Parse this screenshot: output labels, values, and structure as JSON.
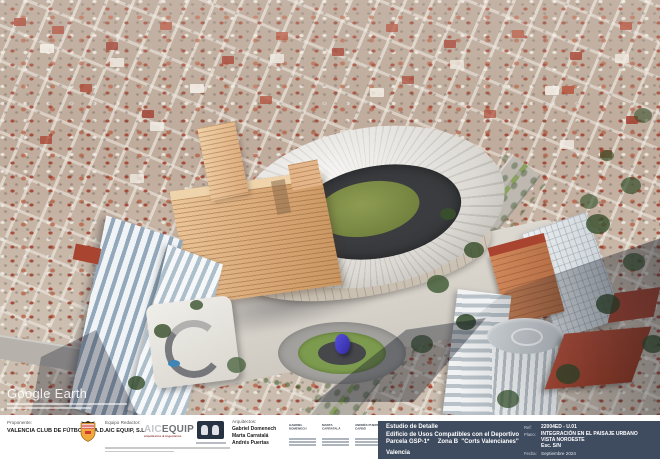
{
  "watermark": {
    "brand": "Google Earth"
  },
  "titleblock": {
    "proponente_label": "Proponente:",
    "proponente_name": "VALENCIA CLUB DE FÚTBOL, S.A.D.",
    "equipo_label": "Equipo Redactor:",
    "equipo_name": "AIC EQUIP, S.L.",
    "aic_logo": {
      "part1": "AIC",
      "part2": "EQUIP",
      "tagline": "arquitectos & ingenieros"
    },
    "arquitectos_label": "Arquitectos:",
    "arquitectos": [
      "Gabriel Domenech",
      "Marta Carratalá",
      "Andrés Puertas"
    ],
    "signatures": [
      "GABRIEL DOMENECH",
      "MARTA CARRATALÁ",
      "ANDRÉS PUERTAS CARBÓ"
    ],
    "project": {
      "line1": "Estudio de Detalle",
      "line2": "Edificio de Usos Compatibles con el Deportivo",
      "line3": "Parcela GSP-1*     Zona B  \"Corts Valencianes\"",
      "line4": "Valencia"
    },
    "ref_label": "Ref:",
    "ref_value": "22004ED - U.01",
    "plano_label": "Plano:",
    "plano_line1": "INTEGRACIÓN EN EL PAISAJE URBANO",
    "plano_line2": "VISTA NOROESTE",
    "plano_line3": "Esc. S/N",
    "fecha_label": "Fecha:",
    "fecha_value": "Septiembre 2024"
  },
  "colors": {
    "title_block_blue": "#3f4b5f",
    "stadium_roof": "#e9e7e2",
    "stadium_bowl": "#3a3c3f",
    "pitch_green": "#7c8c46",
    "annex_orange": "#d9a877",
    "city_roof_red": "#a43a28",
    "sculpture_blue": "#3c33c4"
  }
}
